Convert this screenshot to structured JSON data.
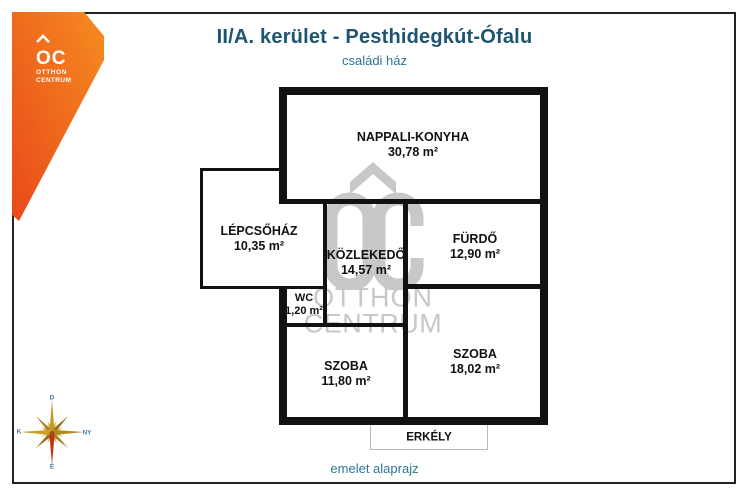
{
  "header": {
    "title": "II/A. kerület - Pesthidegkút-Ófalu",
    "subtitle": "családi ház"
  },
  "footer": {
    "caption": "emelet alaprajz"
  },
  "brand": {
    "mark": "OC",
    "name_line1": "OTTHON",
    "name_line2": "CENTRUM",
    "accent_color": "#f07f1d",
    "accent_color_dark": "#e84e1b"
  },
  "watermark": {
    "line1": "OTTHON",
    "line2": "CENTRUM",
    "color": "#c8c8c8"
  },
  "compass": {
    "top": "D",
    "right": "NY",
    "bottom": "É",
    "left": "K"
  },
  "plan": {
    "rooms": [
      {
        "name": "NAPPALI-KONYHA",
        "area": "30,78 m²"
      },
      {
        "name": "LÉPCSŐHÁZ",
        "area": "10,35 m²"
      },
      {
        "name": "KÖZLEKEDŐ",
        "area": "14,57 m²"
      },
      {
        "name": "FÜRDŐ",
        "area": "12,90 m²"
      },
      {
        "name": "WC",
        "area": "1,20 m²"
      },
      {
        "name": "SZOBA",
        "area": "11,80 m²"
      },
      {
        "name": "SZOBA",
        "area": "18,02 m²"
      },
      {
        "name": "ERKÉLY",
        "area": ""
      }
    ],
    "wall_color": "#111111",
    "title_color": "#1d5570",
    "caption_color": "#2e7694"
  }
}
